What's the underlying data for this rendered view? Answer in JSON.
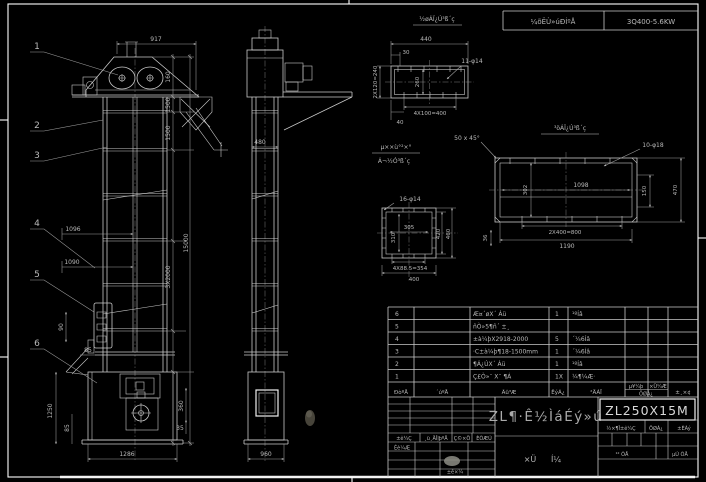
{
  "sheet": {
    "header_bar": {
      "cell1": "¼õËÙ»úÐÍºÅ",
      "cell2": "3Q400-5.6KW"
    }
  },
  "callouts": [
    "1",
    "2",
    "3",
    "4",
    "5",
    "6"
  ],
  "front": {
    "d917": "917",
    "d160": "160",
    "d1500a": "1500",
    "d1500b": "1500",
    "d15000": "15000",
    "d3x2000": "3X2000",
    "d1096": "1096",
    "d1090": "1090",
    "d90": "90",
    "d85a": "85",
    "d1250": "1250",
    "d85b": "85",
    "d1286": "1286",
    "d360": "360",
    "d35": "35"
  },
  "side": {
    "d480": "480",
    "d960": "960"
  },
  "detail1": {
    "label": "½øÁÏ¿Ú³ß´ç",
    "holes": "11-φ14",
    "d440": "440",
    "d30": "30",
    "d2x120": "2X120=240",
    "d260": "260",
    "d4x100": "4X100=400",
    "d40": "40"
  },
  "detail2": {
    "label": "³öÁÏ¿Ú³ß´ç",
    "chamfer": "50 x 45°",
    "holes": "10-φ18",
    "d1098": "1098",
    "d302": "302",
    "d150": "150",
    "d470": "470",
    "d36": "36",
    "d2x400": "2X400=800",
    "d1190": "1190"
  },
  "detail3": {
    "label1": "µ××ù°²×°",
    "label2": "Á¬½Ó³ß´ç",
    "holes": "16-φ14",
    "d305": "305",
    "d310": "310",
    "d420": "420",
    "d460": "460",
    "d4x885": "4X88.5=354",
    "d400": "400"
  },
  "bom": {
    "headers": {
      "seq": "ÐòºÅ",
      "code": "´úºÅ",
      "name": "Ãû³Æ",
      "qty": "ÊýÁ¿",
      "material": "²ÄÁÏ",
      "unit": "µ¥¼þ",
      "total": "×Ü¼Æ",
      "weight": "ÖØÁ¿",
      "remark": "±¸×¢"
    },
    "rows": [
      {
        "no": "6",
        "name": "Æ¤´øX´ Áü",
        "qty": "1",
        "material": "¹ºÍâ"
      },
      {
        "no": "5",
        "name": "ñÒ»5¶ñ´ ±¸",
        "qty": "",
        "material": ""
      },
      {
        "no": "4",
        "name": "±à¼þX2918-2000",
        "qty": "5",
        "material": "´¼6Íâ"
      },
      {
        "no": "3",
        "name": "·C±à¼þ¶18-1500mm",
        "qty": "1",
        "material": "´¼6Íâ"
      },
      {
        "no": "2",
        "name": "¶Á¿ÚX´ Áü",
        "qty": "1",
        "material": "¹ºÍâ"
      },
      {
        "no": "1",
        "name": "Ç£Ò»¨ X¨ ¶Á",
        "qty": "1X",
        "material": "¼¶¼Æ·"
      }
    ]
  },
  "titleblock": {
    "model": "ZL250X15M",
    "title": "ZL¶·Ê½ÌáÉý»ú",
    "doc_type_1": "×Ü",
    "doc_type_2": "Í¼",
    "rev": {
      "mark": "±ê¼Ç",
      "file": "¸ü¸ÄÎļþºÅ",
      "sign": "Ç©×Ö",
      "date": "ÈÕÆÚ"
    },
    "design": "Éè¼Æ",
    "standard": "±ê×¼",
    "stage": "½×¶Î±ê¼Ç",
    "weight": "ÖØÁ¿",
    "scale": "±ÈÀý",
    "sheet_total": "¹²   ÕÅ",
    "sheet_no": "µÚ   ÕÅ"
  }
}
